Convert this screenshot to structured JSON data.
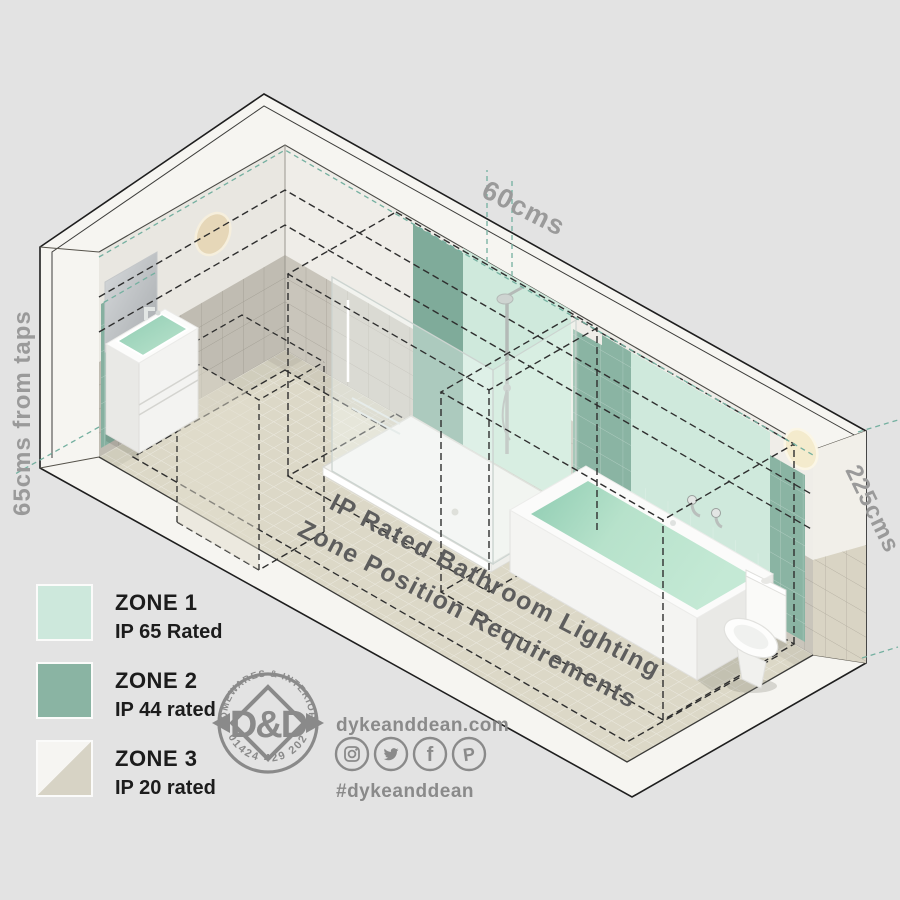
{
  "diagram": {
    "title_line1": "IP Rated Bathroom Lighting",
    "title_line2": "Zone Position Requirements",
    "measurements": {
      "top": "60cms",
      "left": "65cms from taps",
      "right": "225cms"
    }
  },
  "legend": {
    "items": [
      {
        "zone": "ZONE 1",
        "rating": "IP 65 Rated",
        "color": "#cde8dc"
      },
      {
        "zone": "ZONE 2",
        "rating": "IP 44 rated",
        "color": "#8ab4a3"
      },
      {
        "zone": "ZONE 3",
        "rating": "IP 20 rated",
        "color": "#d7d3c5",
        "color2": "#f6f5f2"
      }
    ]
  },
  "branding": {
    "logo": {
      "top_text": "HOMEWARES & INTERIORS",
      "bottom_text": "01424 429 202",
      "monogram": "D&D"
    },
    "website": "dykeanddean.com",
    "hashtag": "#dykeanddean",
    "social_icons": [
      "instagram-icon",
      "twitter-icon",
      "facebook-icon",
      "pinterest-icon"
    ]
  },
  "colors": {
    "zone1_mint": "#cde8dc",
    "zone2_green": "#8ab4a3",
    "zone3_beige": "#d7d3c5",
    "teal_dash": "#74b0a0",
    "black_dash": "#2e2e2e",
    "label_gray": "#9a9a9a",
    "title_gray": "#5d5d5d",
    "brand_gray": "#8a8a8a",
    "background": "#e3e3e3"
  }
}
